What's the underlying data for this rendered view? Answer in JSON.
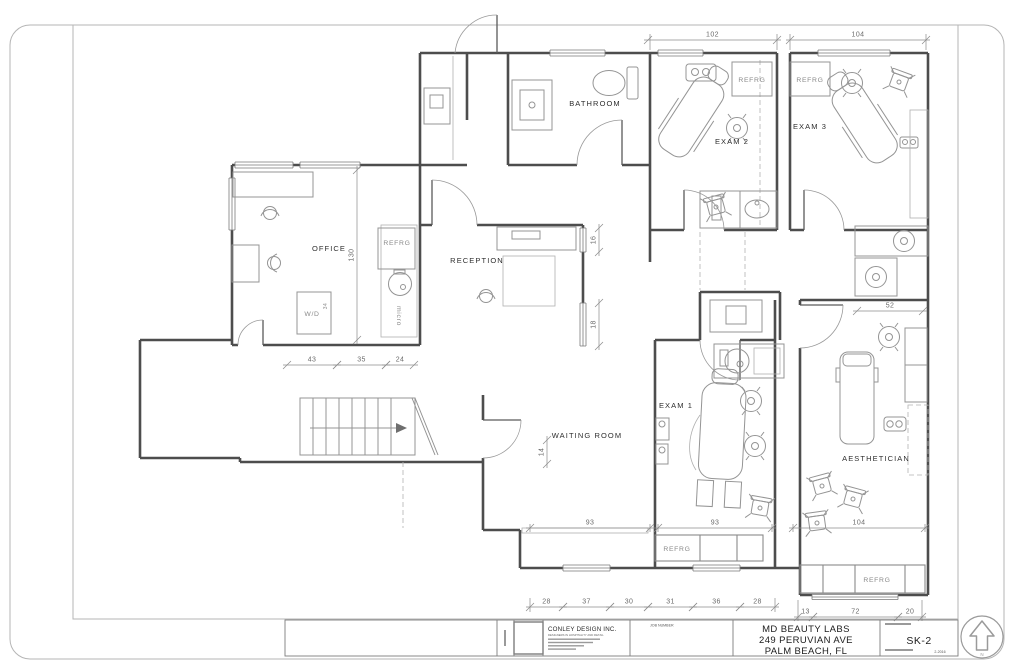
{
  "title_block": {
    "firm_name": "CONLEY DESIGN INC.",
    "firm_tagline": "DESIGNERS IN HOSPITALITY AND RETAIL",
    "job_number_label": "JOB NUMBER",
    "project_name": "MD BEAUTY LABS",
    "project_address1": "249 PERUVIAN AVE",
    "project_address2": "PALM BEACH, FL",
    "sheet_number": "SK-2",
    "date": "2-2016",
    "north_label": "N"
  },
  "plan": {
    "room_labels": [
      {
        "id": "office",
        "label": "OFFICE",
        "x": 329,
        "y": 251
      },
      {
        "id": "reception",
        "label": "RECEPTION",
        "x": 477,
        "y": 263
      },
      {
        "id": "bathroom",
        "label": "BATHROOM",
        "x": 595,
        "y": 106
      },
      {
        "id": "exam-2",
        "label": "EXAM 2",
        "x": 732,
        "y": 144
      },
      {
        "id": "exam-3",
        "label": "EXAM 3",
        "x": 810,
        "y": 129
      },
      {
        "id": "exam-1",
        "label": "EXAM 1",
        "x": 676,
        "y": 408
      },
      {
        "id": "waiting-room",
        "label": "WAITING ROOM",
        "x": 587,
        "y": 438
      },
      {
        "id": "aesthetician",
        "label": "AESTHETICIAN",
        "x": 876,
        "y": 461
      }
    ],
    "fixture_labels": [
      {
        "id": "refrg-kitchenette",
        "label": "REFRG",
        "x": 397,
        "y": 245,
        "r": 0,
        "cls": "fix-lbl"
      },
      {
        "id": "refrg-exam2",
        "label": "REFRG",
        "x": 752,
        "y": 82,
        "r": 0,
        "cls": "fix-lbl"
      },
      {
        "id": "refrg-exam3",
        "label": "REFRG",
        "x": 810,
        "y": 82,
        "r": 0,
        "cls": "fix-lbl"
      },
      {
        "id": "refrg-exam1",
        "label": "REFRG",
        "x": 677,
        "y": 551,
        "r": 0,
        "cls": "fix-lbl"
      },
      {
        "id": "refrg-aesthetician",
        "label": "REFRG",
        "x": 877,
        "y": 582,
        "r": 0,
        "cls": "fix-lbl"
      },
      {
        "id": "washer-dryer",
        "label": "W/D",
        "x": 312,
        "y": 316,
        "r": 0,
        "cls": "fix-lbl"
      },
      {
        "id": "microwave",
        "label": "micro",
        "x": 397,
        "y": 316,
        "r": 90,
        "cls": "fix-lbl"
      },
      {
        "id": "wd-dim",
        "label": "34",
        "x": 327,
        "y": 306,
        "r": -90,
        "cls": "tiny-lbl"
      }
    ],
    "dimensions": [
      {
        "value": "102",
        "o": "h",
        "y": 40,
        "a": 648,
        "b": 777
      },
      {
        "value": "104",
        "o": "h",
        "y": 40,
        "a": 790,
        "b": 926
      },
      {
        "value": "130",
        "o": "v",
        "x": 357,
        "a": 170,
        "b": 340
      },
      {
        "value": "16",
        "o": "v",
        "x": 599,
        "a": 228,
        "b": 252
      },
      {
        "value": "18",
        "o": "v",
        "x": 599,
        "a": 303,
        "b": 346
      },
      {
        "value": "14",
        "o": "v",
        "x": 547,
        "a": 440,
        "b": 464
      },
      {
        "value": "43",
        "o": "h",
        "y": 365,
        "a": 287,
        "b": 337
      },
      {
        "value": "35",
        "o": "h",
        "y": 365,
        "a": 337,
        "b": 386
      },
      {
        "value": "24",
        "o": "h",
        "y": 365,
        "a": 386,
        "b": 414
      },
      {
        "value": "93",
        "o": "h",
        "y": 528,
        "a": 530,
        "b": 650
      },
      {
        "value": "93",
        "o": "h",
        "y": 528,
        "a": 658,
        "b": 772
      },
      {
        "value": "52",
        "o": "h",
        "y": 311,
        "a": 857,
        "b": 923
      },
      {
        "value": "104",
        "o": "h",
        "y": 528,
        "a": 793,
        "b": 925
      },
      {
        "value": "28",
        "o": "h",
        "y": 607,
        "a": 530,
        "b": 563
      },
      {
        "value": "37",
        "o": "h",
        "y": 607,
        "a": 563,
        "b": 610
      },
      {
        "value": "30",
        "o": "h",
        "y": 607,
        "a": 610,
        "b": 648
      },
      {
        "value": "31",
        "o": "h",
        "y": 607,
        "a": 648,
        "b": 693
      },
      {
        "value": "36",
        "o": "h",
        "y": 607,
        "a": 693,
        "b": 740
      },
      {
        "value": "28",
        "o": "h",
        "y": 607,
        "a": 740,
        "b": 775
      },
      {
        "value": "13",
        "o": "h",
        "y": 617,
        "a": 798,
        "b": 813
      },
      {
        "value": "72",
        "o": "h",
        "y": 617,
        "a": 813,
        "b": 898
      },
      {
        "value": "20",
        "o": "h",
        "y": 617,
        "a": 898,
        "b": 922
      }
    ]
  }
}
